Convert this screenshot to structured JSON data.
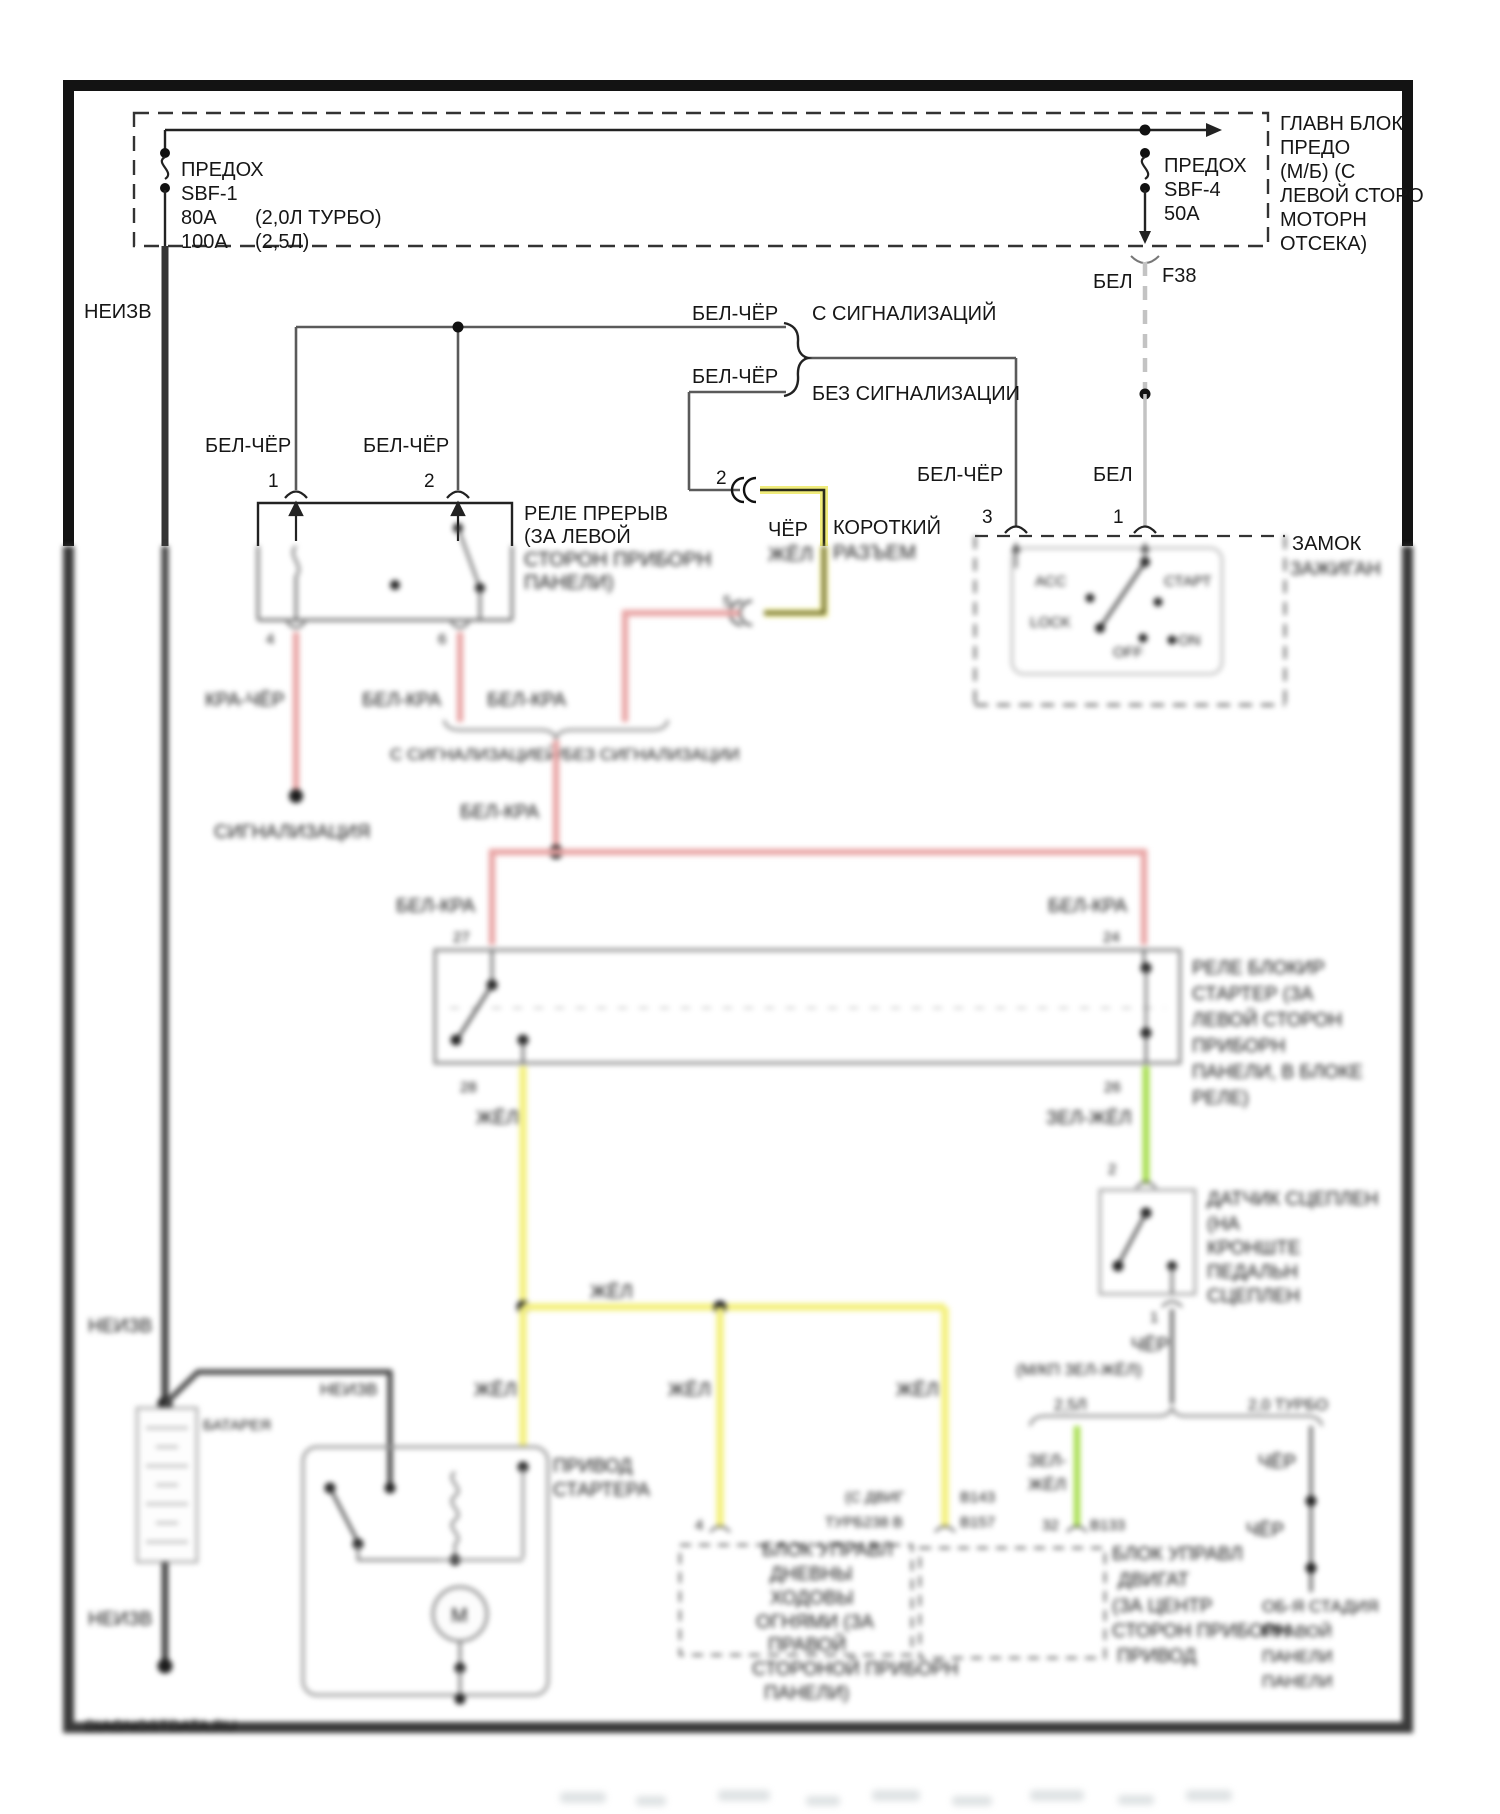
{
  "labels": {
    "neizv": "НЕИЗВ",
    "bel_cher": "БЕЛ-ЧЁР",
    "bel": "БЕЛ",
    "cher": "ЧЁР",
    "zhel": "ЖЁЛ",
    "bel_kra": "БЕЛ-КРА",
    "kra_cher": "КРА-ЧЁР",
    "zel": "ЗЕЛ-",
    "zel_zhel": "ЗЕЛ-ЖЁЛ",
    "f38": "F38",
    "fuse1_title": "ПРЕДОХ",
    "fuse1_id": "SBF-1",
    "fuse1_r1": "80А",
    "fuse1_v1": "(2,0Л ТУРБО)",
    "fuse1_r2": "100А",
    "fuse1_v2": "(2,5Л)",
    "fuse2_title": "ПРЕДОХ",
    "fuse2_id": "SBF-4",
    "fuse2_r": "50А",
    "with_alarm": "С СИГНАЛИЗАЦИЙ",
    "without_alarm": "БЕЗ СИГНАЛИЗАЦИИ",
    "merge_note": "С СИГНАЛИЗАЦИЕЙ/БЕЗ СИГНАЛИЗАЦИИ",
    "signalizaciya": "СИГНАЛИЗАЦИЯ",
    "korotkiy": "КОРОТКИЙ",
    "razem": "РАЗЪЕМ",
    "zamok": "ЗАМОК",
    "zazhigan": "ЗАЖИГАН",
    "pos_acc": "АСС",
    "pos_start": "СТАРТ",
    "pos_lock": "LOCK",
    "pos_off": "OFF",
    "pos_on": "ON",
    "pin1": "1",
    "pin2": "2",
    "pin3": "3",
    "pin4": "4",
    "pin5": "5",
    "pin6": "6",
    "pin27": "27",
    "pin24": "24",
    "pin28": "28",
    "pin26": "26",
    "pin32": "32",
    "mkp_note": "(М/КП ЗЕЛ-ЖЁЛ)",
    "variant_25": "2,5Л",
    "variant_20t": "2,0 ТУРБО",
    "code_sdvig": "(С ДВИГ",
    "code_b143": "В143",
    "code_turb": "ТУРБ238 В",
    "code_b157": "В157",
    "code_b133": "В133",
    "battery": "БАТАРЕЯ",
    "privod": "ПРИВОД",
    "startera": "СТАРТЕРА",
    "motor_m": "M",
    "watermark": "DIAGNOSTDATA.RU"
  },
  "fuse_block_label": [
    "ГЛАВН БЛОК",
    "ПРЕДО",
    "(М/Б) (С",
    "ЛЕВОЙ СТОРО",
    "МОТОРН",
    "ОТСЕКА)"
  ],
  "interrupt_relay_label": [
    "РЕЛЕ ПРЕРЫВ",
    "(ЗА ЛЕВОЙ",
    "СТОРОН ПРИБОРН",
    "ПАНЕЛИ)"
  ],
  "start_relay_label": [
    "РЕЛЕ БЛОКИР",
    "СТАРТЕР (ЗА",
    "ЛЕВОЙ СТОРОН",
    "ПРИБОРН",
    "ПАНЕЛИ, В БЛОКЕ",
    "РЕЛЕ)"
  ],
  "clutch_label": [
    "ДАТЧИК СЦЕПЛЕН",
    "(НА",
    "КРОНШТЕ",
    "ПЕДАЛЬН",
    "СЦЕПЛЕН"
  ],
  "ecu_left_label": [
    "БЛОК УПРАВЛ",
    "ДНЕВНЫ",
    "ХОДОВЫ",
    "ОГНЯМИ (ЗА",
    "ПРАВОЙ",
    "СТОРОНОЙ ПРИБОРН",
    "ПАНЕЛИ)"
  ],
  "ecu_right_label_a": [
    "БЛОК УПРАВЛ",
    "ДВИГАТ",
    "(ЗА ЦЕНТР",
    "СТОРОН ПРИБОРН",
    "ПРИВОД"
  ],
  "ecu_right_label_b": [
    "ОБ-Я СТАДИЯ",
    "ПРАВОЙ",
    "ПАНЕЛИ",
    "ПАНЕЛИ"
  ]
}
